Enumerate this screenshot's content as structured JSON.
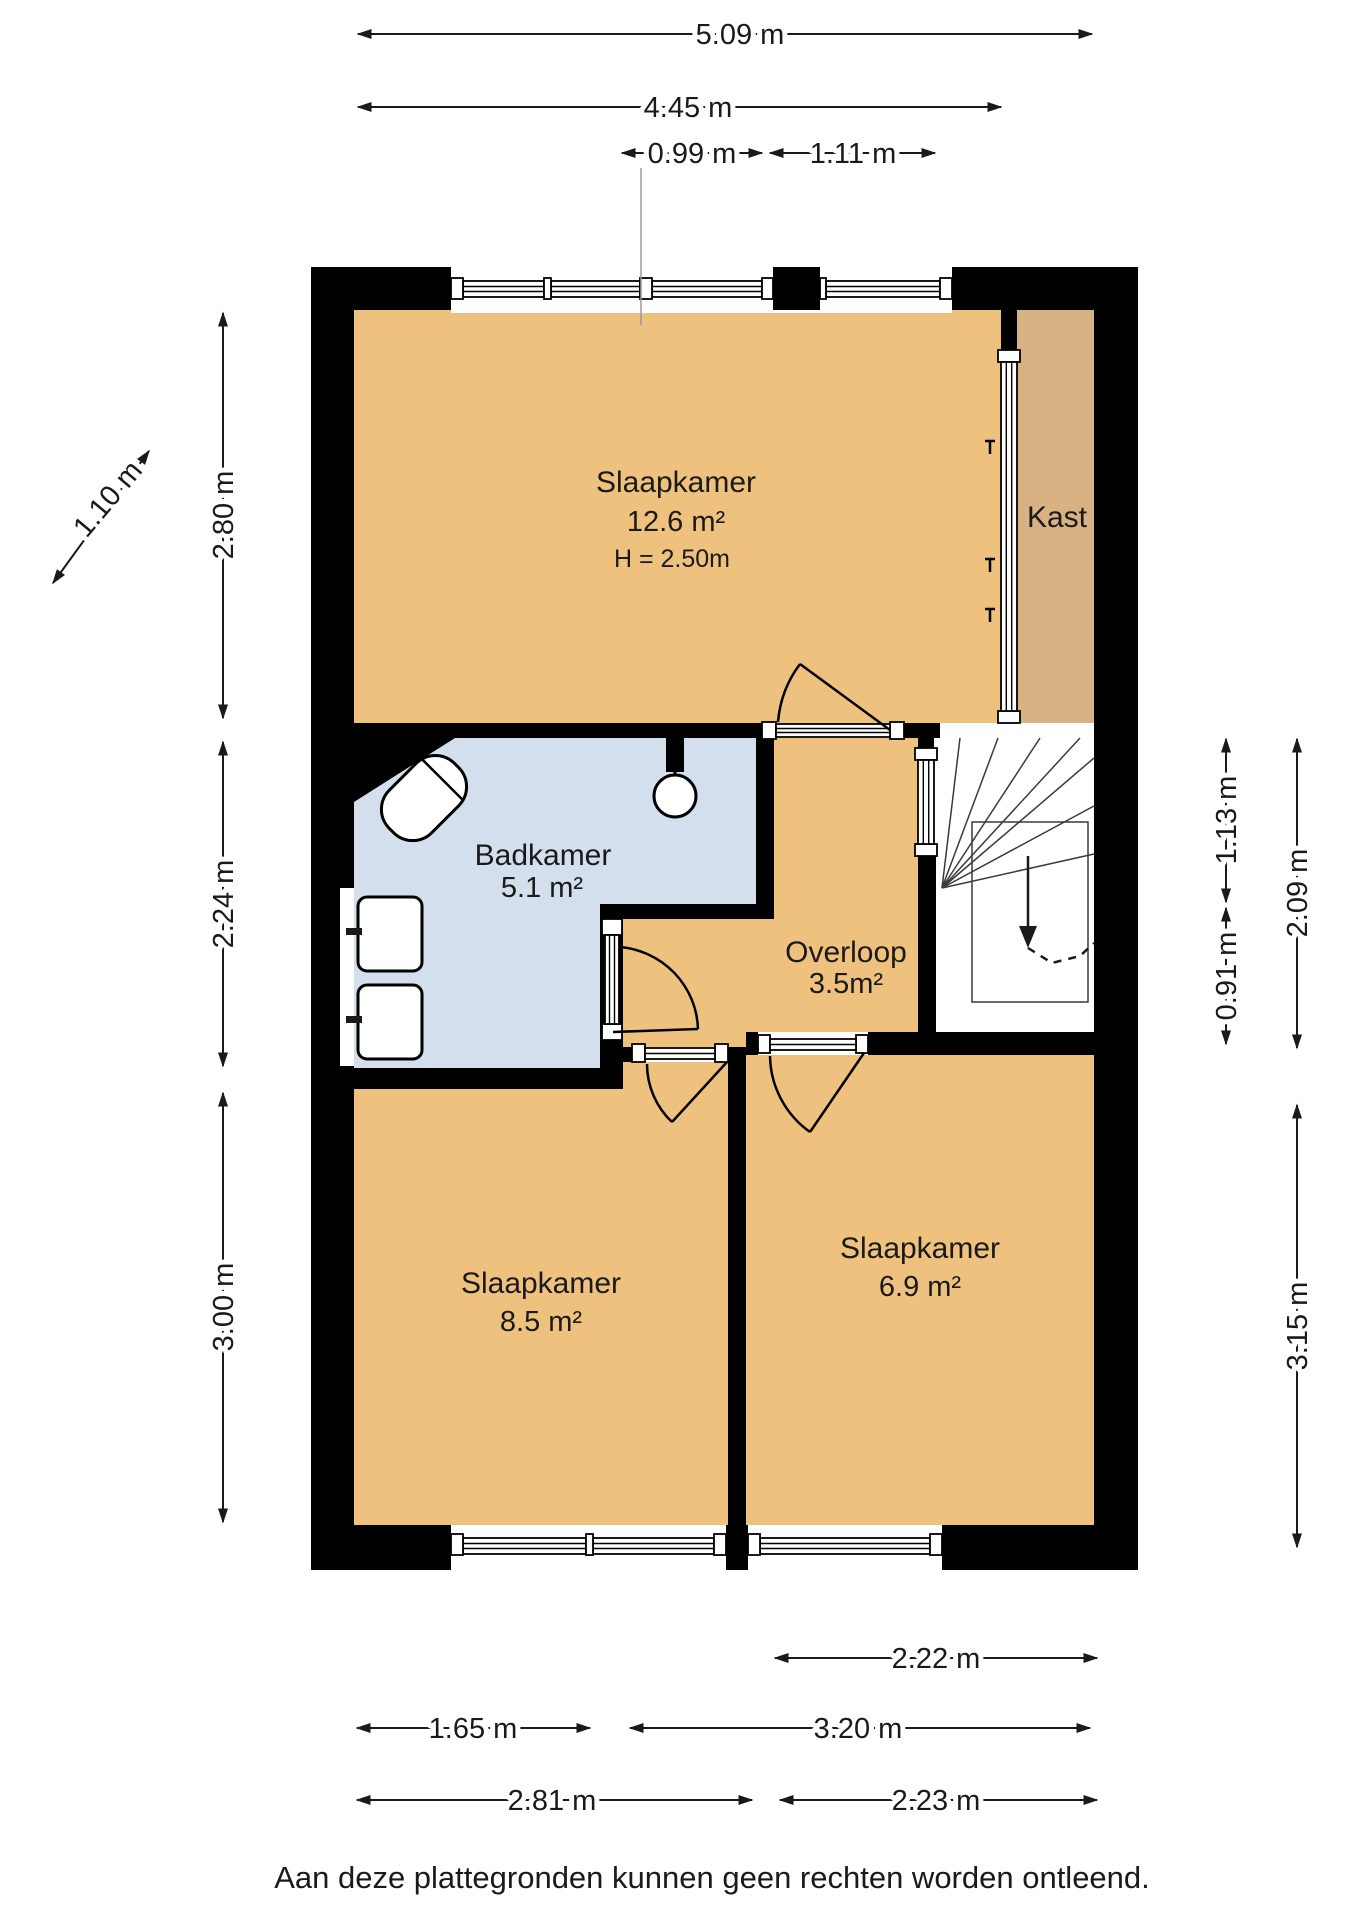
{
  "rooms": {
    "slaapkamer1": {
      "label": "Slaapkamer",
      "area": "12.6 m²",
      "ceiling": "H = 2.50m"
    },
    "kast": {
      "label": "Kast"
    },
    "badkamer": {
      "label": "Badkamer",
      "area": "5.1 m²"
    },
    "overloop": {
      "label": "Overloop",
      "area": "3.5m²"
    },
    "slaapkamer2": {
      "label": "Slaapkamer",
      "area": "8.5 m²"
    },
    "slaapkamer3": {
      "label": "Slaapkamer",
      "area": "6.9 m²"
    }
  },
  "dims": {
    "d509": "5.09 m",
    "d445": "4.45 m",
    "d099": "0.99 m",
    "d111": "1.11 m",
    "d280": "2.80 m",
    "d224": "2.24 m",
    "d300": "3.00 m",
    "d110": "1.10 m",
    "d113": "1.13 m",
    "d091": "0.91 m",
    "d209": "2.09 m",
    "d315": "3.15 m",
    "d222": "2.22 m",
    "d165": "1.65 m",
    "d320": "3.20 m",
    "d281": "2.81 m",
    "d223": "2.23 m"
  },
  "disclaimer": "Aan deze plattegronden kunnen geen rechten worden ontleend.",
  "colors": {
    "bedroom": "#efc17e",
    "closet": "#d9b284",
    "bathroom": "#d3dfed",
    "wall": "#000000",
    "dim_line": "#1a1a1a"
  }
}
